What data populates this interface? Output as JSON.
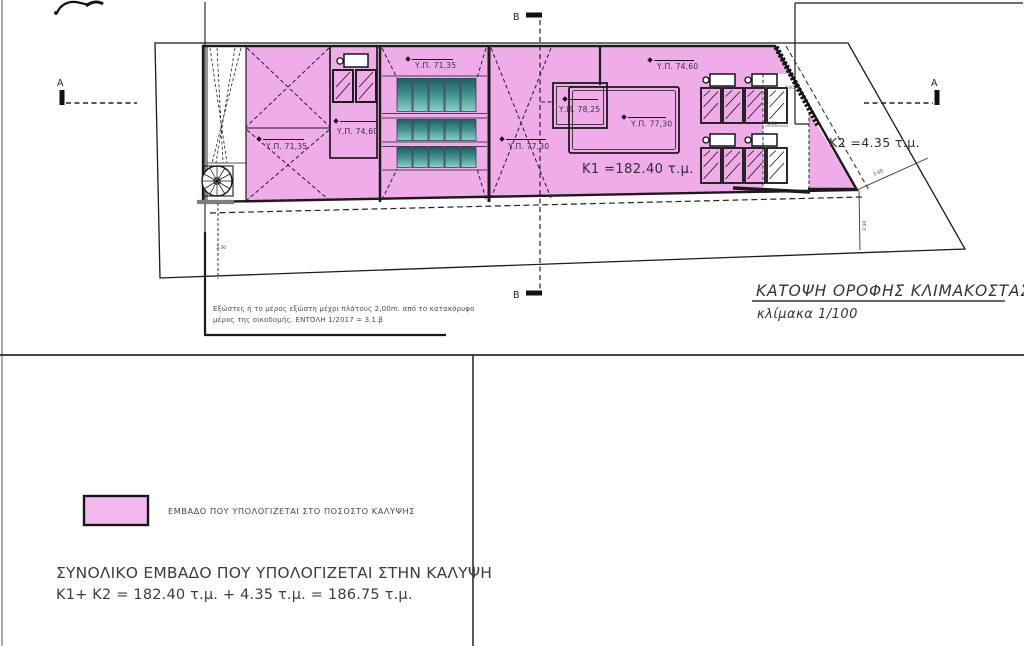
{
  "drawing": {
    "title": "ΚΑΤΟΨΗ ΟΡΟΦΗΣ ΚΛΙΜΑΚΟΣΤΑΣΙΟΥ",
    "scale": "κλίμακα 1/100",
    "section_markers": {
      "a": "A",
      "b": "B"
    },
    "height_labels": [
      "Υ.Π. 71,35",
      "Υ.Π. 74,60",
      "Υ.Π. 71,35",
      "Υ.Π. 77,30",
      "Υ.Π. 78,25",
      "Υ.Π. 77,30",
      "Υ.Π. 74,60"
    ],
    "areas": {
      "k1": "K1 =182.40 τ.μ.",
      "k2": "K2 =4.35 τ.μ."
    },
    "dimensions": {
      "left_offset": "3.30",
      "right_diag": "3.00",
      "right_offset": "3.30",
      "panel_top": "2.00",
      "panel_bottom": "2.00"
    },
    "note": {
      "line1": "Εξώστες ή το μέρος εξώστη μέχρι πλάτους 2,00m. από το κατακόρυφο",
      "line2": "μέρος της οικοδομής.  ΕΝΤΟΛΗ 1/2017 = 3.1.β"
    }
  },
  "legend": {
    "label": "ΕΜΒΑΔΟ ΠΟΥ ΥΠΟΛΟΓΙΖΕΤΑΙ ΣΤΟ ΠΟΣΟΣΤΟ ΚΑΛΥΨΗΣ"
  },
  "summary": {
    "line1": "ΣΥΝΟΛΙΚΟ ΕΜΒΑΔΟ ΠΟΥ ΥΠΟΛΟΓΙΖΕΤΑΙ ΣΤΗΝ ΚΑΛΥΨΗ",
    "line2": "K1+ K2 = 182.40 τ.μ. + 4.35 τ.μ. = 186.75 τ.μ."
  },
  "colors": {
    "coverage_pink": "#F0ACE8",
    "legend_pink": "#F3B9EF",
    "skylight_teal": "#3E8E8C",
    "line": "#1B1B1B"
  }
}
